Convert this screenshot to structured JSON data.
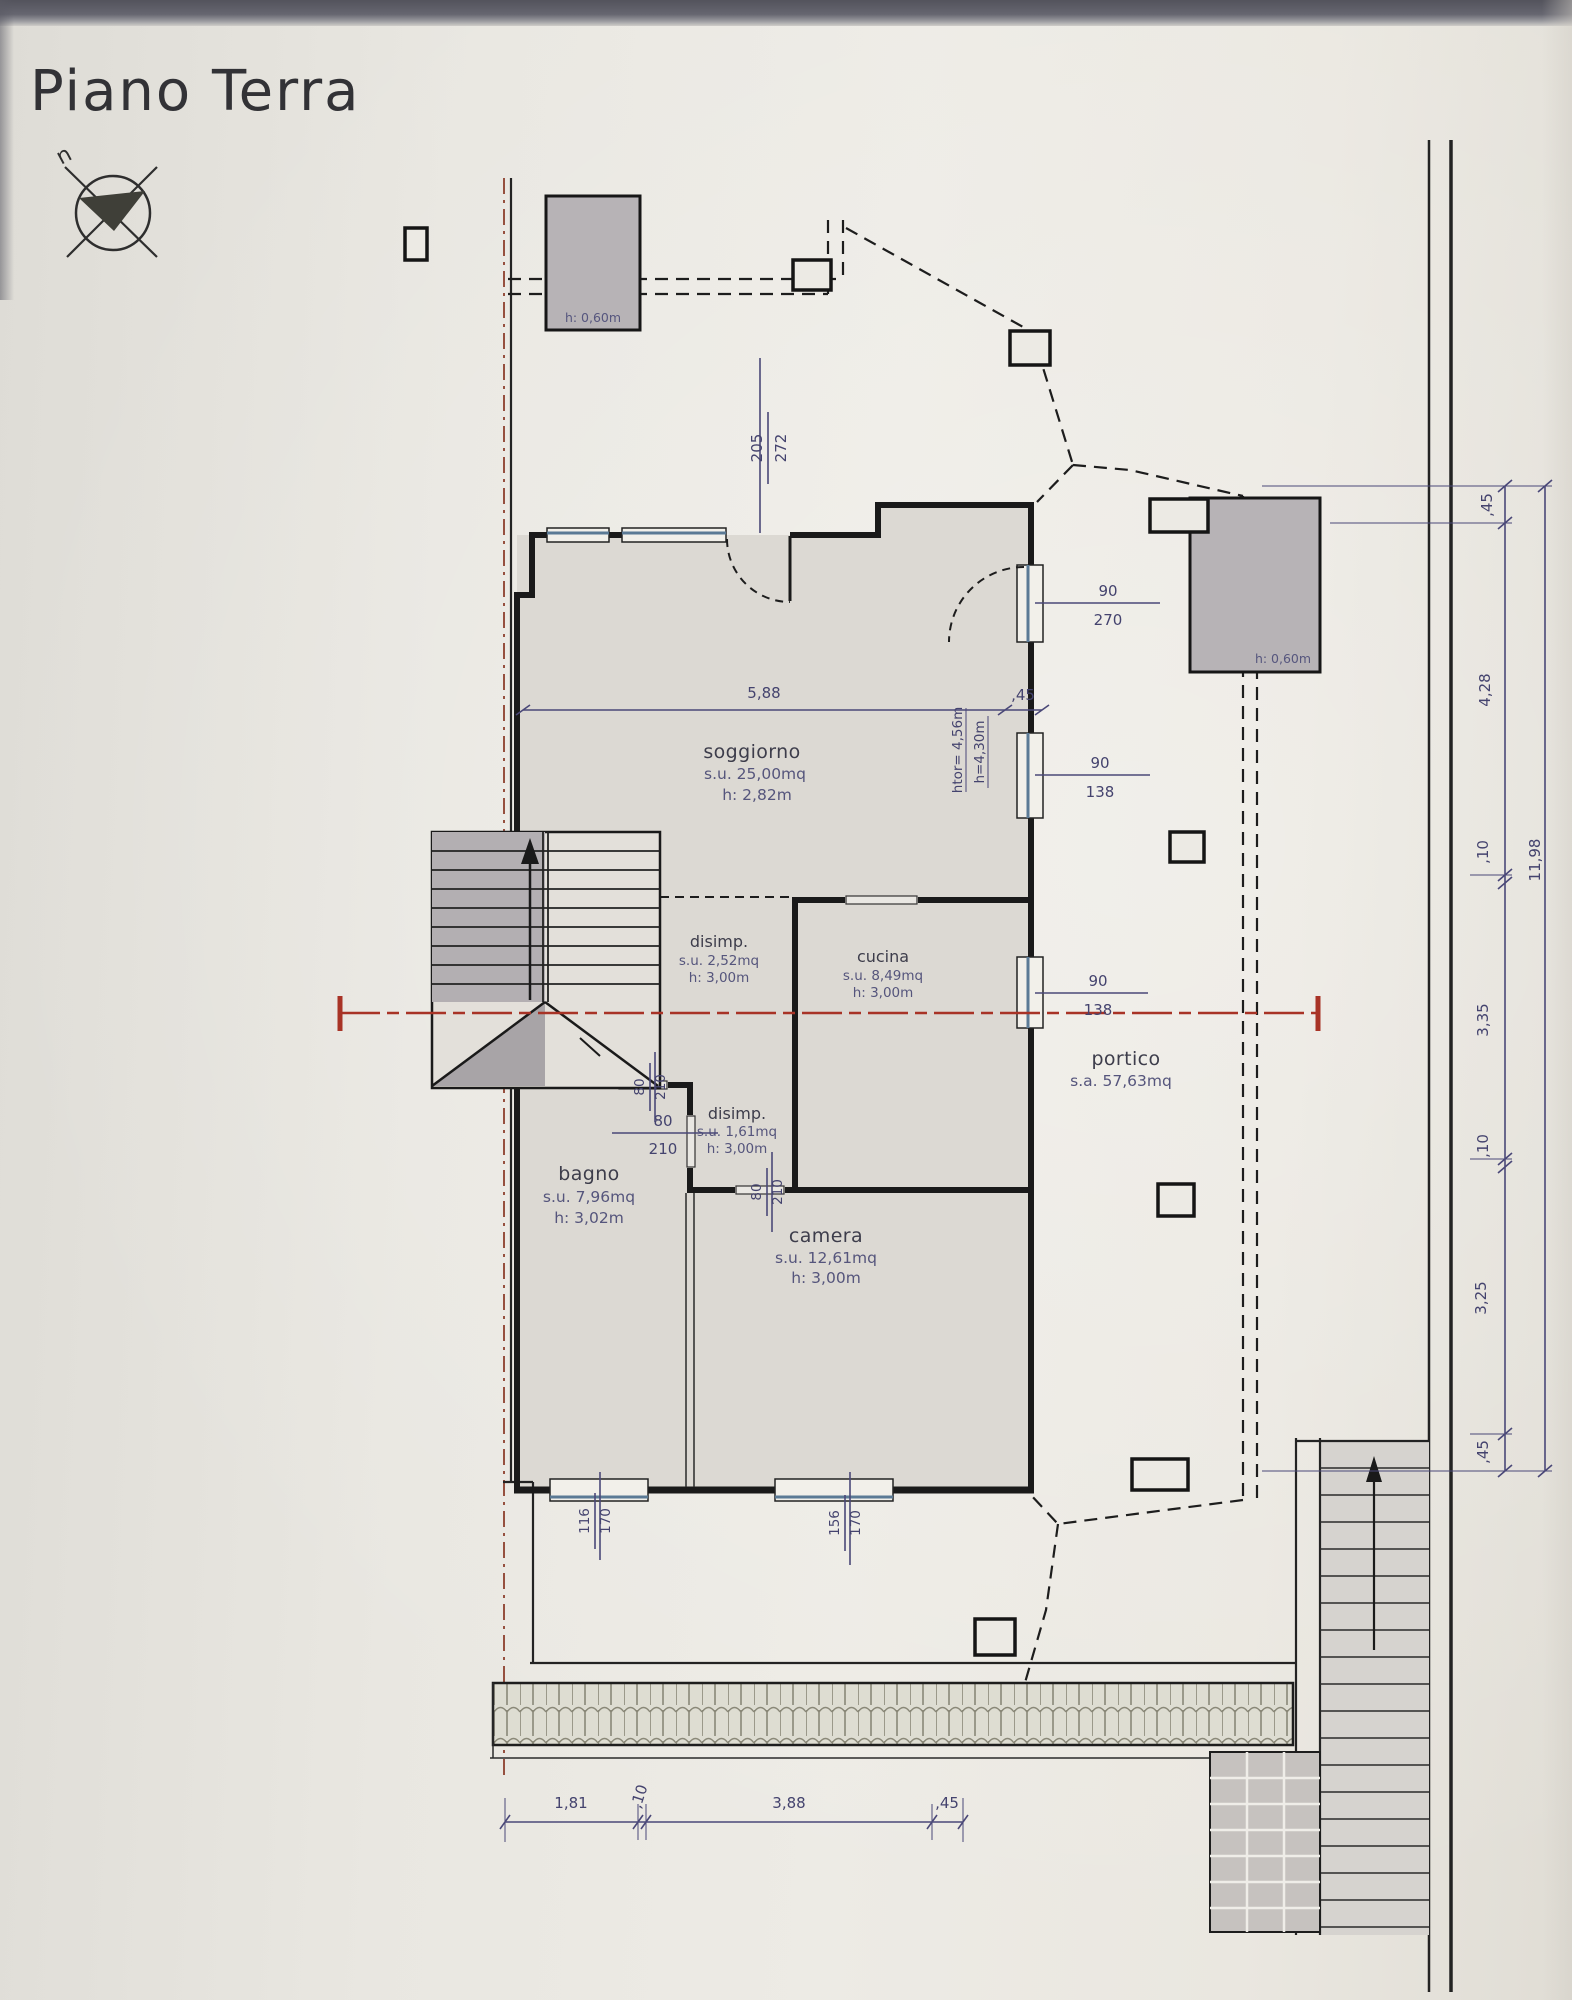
{
  "title": "Piano Terra",
  "compass": {
    "north_label": "n"
  },
  "rooms": {
    "soggiorno": {
      "name": "soggiorno",
      "area": "s.u. 25,00mq",
      "height": "h: 2,82m"
    },
    "disimp_1": {
      "name": "disimp.",
      "area": "s.u. 2,52mq",
      "height": "h: 3,00m"
    },
    "cucina": {
      "name": "cucina",
      "area": "s.u. 8,49mq",
      "height": "h: 3,00m"
    },
    "disimp_2": {
      "name": "disimp.",
      "area": "s.u. 1,61mq",
      "height": "h: 3,00m"
    },
    "bagno": {
      "name": "bagno",
      "area": "s.u. 7,96mq",
      "height": "h: 3,02m"
    },
    "camera": {
      "name": "camera",
      "area": "s.u. 12,61mq",
      "height": "h: 3,00m"
    },
    "portico": {
      "name": "portico",
      "area": "s.a. 57,63mq"
    }
  },
  "shafts": {
    "left": "h: 0,60m",
    "right": "h: 0,60m"
  },
  "heights": {
    "h_tor": "htor= 4,56m",
    "h_sub": "h=4,30m"
  },
  "openings": {
    "entry_205_272": {
      "w": "205",
      "h": "272"
    },
    "door_90_270": {
      "w": "90",
      "h": "270"
    },
    "window_sogg_90_138": {
      "w": "90",
      "h": "138"
    },
    "window_cucina_90_138": {
      "w": "90",
      "h": "138"
    },
    "door_disimp_80_210": {
      "w": "80",
      "h": "210"
    },
    "door_bagno_80_210": {
      "w": "80",
      "h": "210"
    },
    "door_camera_80_210": {
      "w": "80",
      "h": "210"
    },
    "window_bagno_116_170": {
      "w": "116",
      "h": "170"
    },
    "window_camera_156_170": {
      "w": "156",
      "h": "170"
    }
  },
  "dimensions": {
    "soggiorno_width": "5,88",
    "soggiorno_wall": ",45",
    "right_chain": [
      ",45",
      "4,28",
      ",10",
      "3,35",
      ",10",
      "3,25",
      ",45"
    ],
    "right_total": "11,98",
    "bottom_chain": [
      "1,81",
      ",10",
      "3,88",
      ",45"
    ]
  },
  "colors": {
    "dimension_blue": "#4a4878",
    "boundary_red": "#96503f",
    "section_red": "#a83326",
    "window_blue": "#5b7a95"
  }
}
